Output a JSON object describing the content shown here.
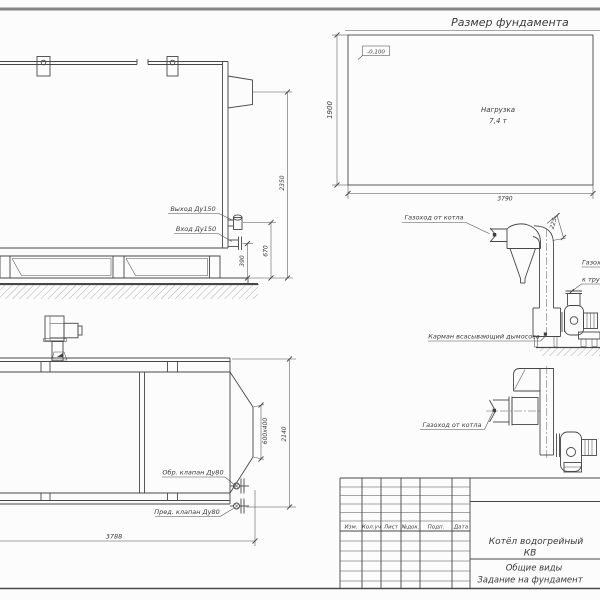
{
  "sheet": {
    "colors": {
      "background": "#fcfcfc",
      "ink": "#474747"
    },
    "views": {
      "foundation_plan": {
        "title": "Размер фундамента",
        "elevation_mark": "-0,100",
        "load_line1": "Нагрузка",
        "load_line2": "7,4 т",
        "dim_width": "3790",
        "dim_depth": "1900"
      },
      "boiler_side_view": {
        "label_outlet": "Выход Ду150",
        "label_inlet": "Вход Ду150",
        "dim_total_height": "2350",
        "dim_outlet_height": "670",
        "dim_inlet_height": "390"
      },
      "boiler_plan_view": {
        "label_check_valve": "Обр. клапан Ду80",
        "label_safety_valve": "Пред. клапан Ду80",
        "dim_length": "3788",
        "dim_width": "2140",
        "dim_flue_outlet": "600х400"
      },
      "flue_elevation_view": {
        "label_flue_from_boiler": "Газоход от котла",
        "label_flue_to_stack_line1": "Газоход",
        "label_flue_to_stack_line2": "к трубе",
        "label_suction_pocket": "Карман всасывающий дымососа",
        "dim_offset": "225"
      },
      "flue_plan_view": {
        "label_flue_from_boiler": "Газоход от котла"
      },
      "title_block": {
        "columns": [
          "Изм.",
          "Кол.уч",
          "Лист",
          "№док.",
          "Подп.",
          "Дата"
        ],
        "product_line1": "Котёл водогрейный",
        "product_line2": "КВ",
        "doc_type_line1": "Общие виды",
        "doc_type_line2": "Задание на фундамент"
      }
    }
  }
}
